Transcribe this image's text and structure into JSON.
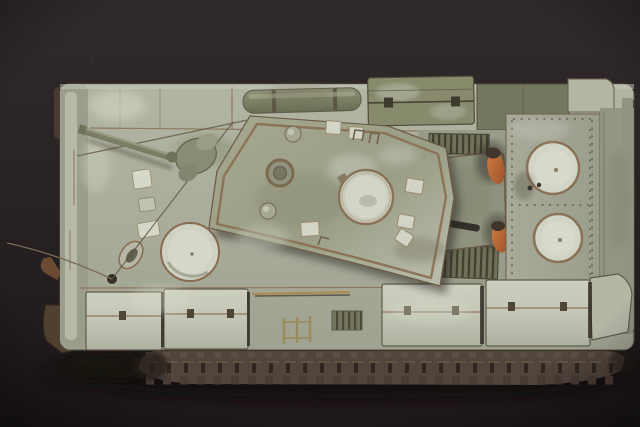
{
  "scene": {
    "type": "photograph",
    "title": "Overhead photograph of a weathered military tank scale model on a dark backdrop",
    "subject": "tank scale model",
    "view": "top-down",
    "facing": "left",
    "finish": "worn winter whitewash over olive green with rust-toned panel seams",
    "key_features": [
      "short gun barrel pointing to front-left",
      "angled turret roof with large round commander hatch and periscope ring",
      "driver hatch circle and vent on front deck",
      "two rust-orange exhaust stubs on engine deck",
      "riveted rear deck plate with two circular filler caps",
      "slatted radiator grilles",
      "whitewashed stowage boxes along both fenders",
      "rolled tarpaulin and tool box on far fender",
      "exposed lower track run with cleats",
      "thin whip antenna trailing off the front-left edge"
    ]
  },
  "palette": {
    "backdrop": "#2b2526",
    "backdrop-deep": "#1e191a",
    "hull": "#aeb19f",
    "whitewash": "#c9cbbc",
    "metal-light": "#d6d8ca",
    "olive": "#7e8266",
    "olive-dark": "#5f5a48",
    "rust-seam": "#8a6a50",
    "track": "#51453c",
    "track-dark": "#2d2622",
    "exhaust-orange": "#c56f38",
    "shadow": "#141010"
  }
}
